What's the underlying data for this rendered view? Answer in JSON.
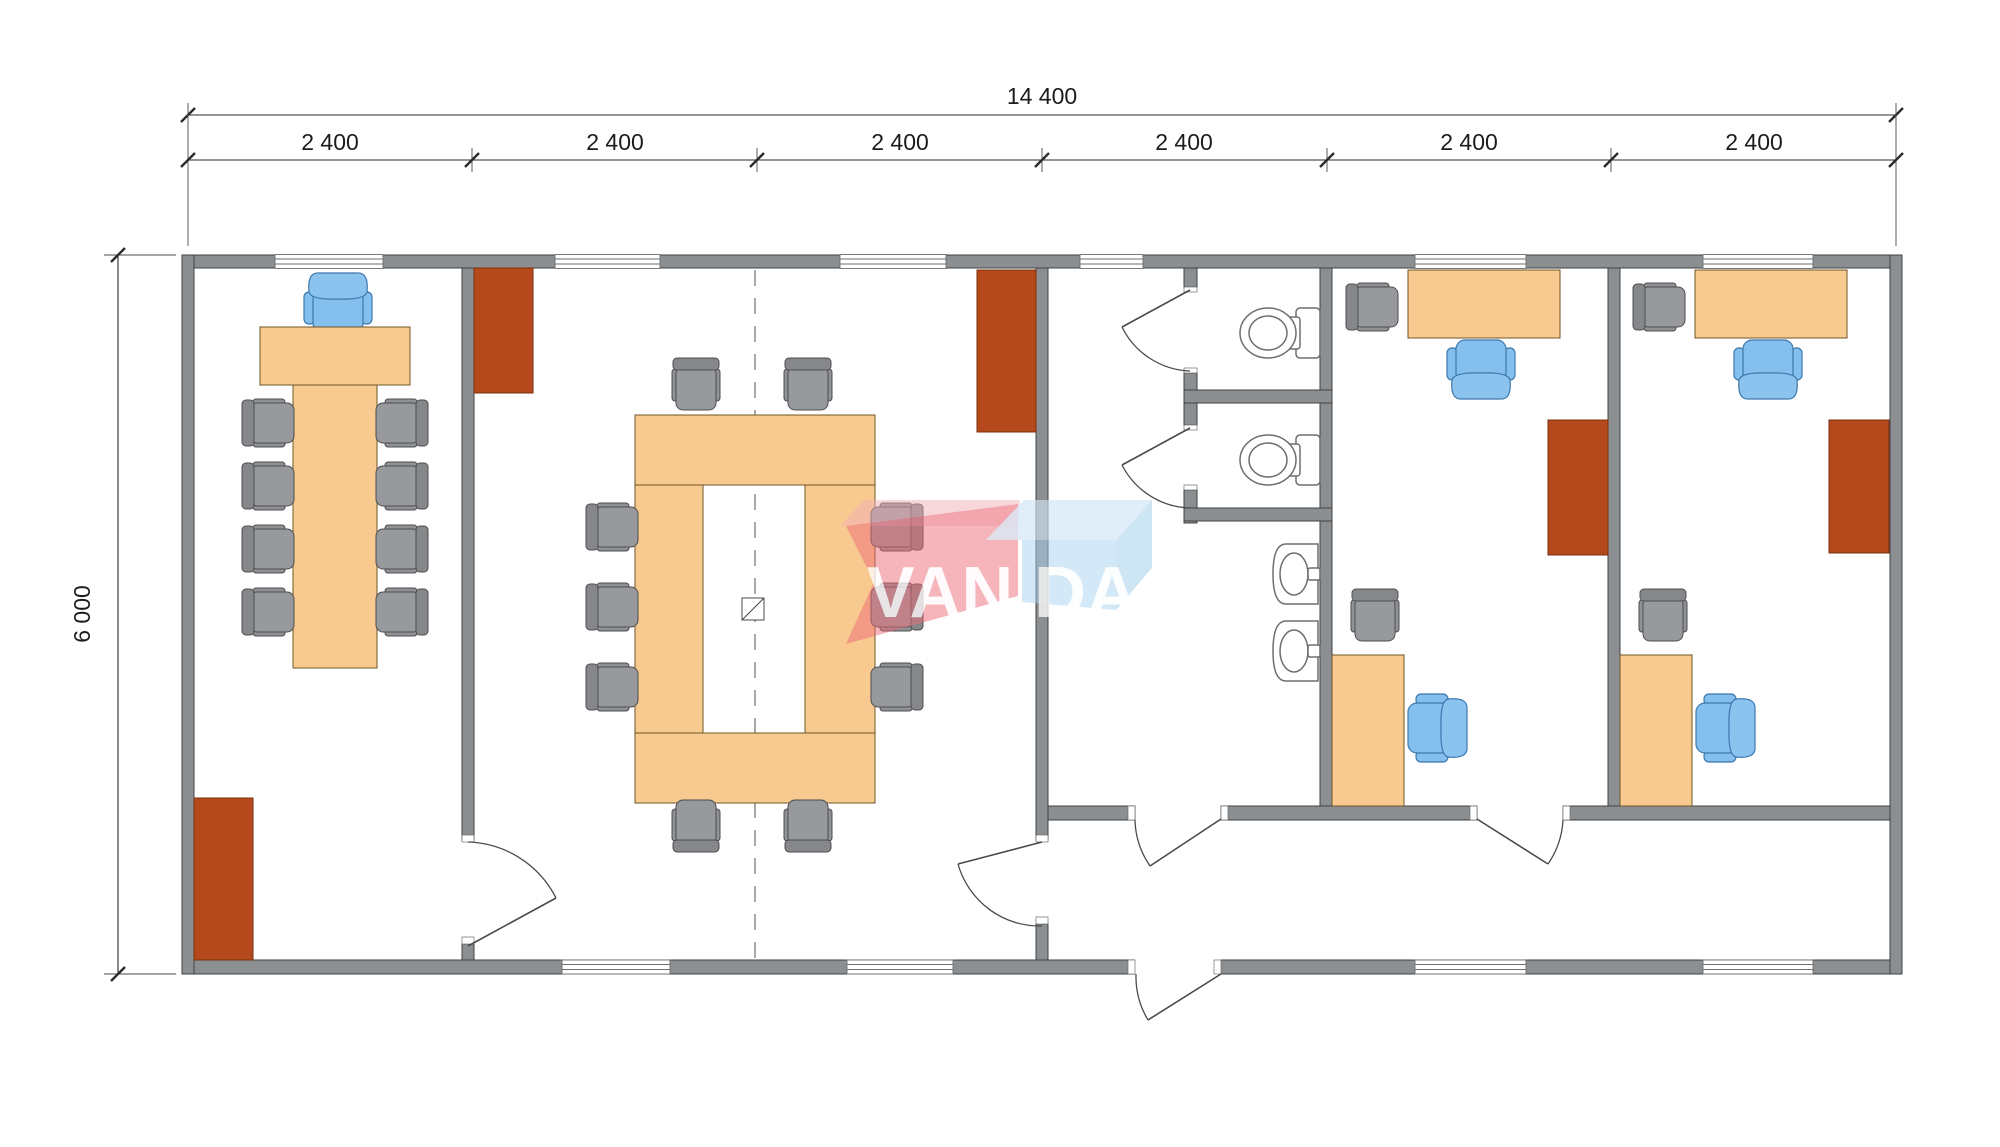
{
  "dimensions": {
    "total_width_label": "14 400",
    "segment_labels": [
      "2 400",
      "2 400",
      "2 400",
      "2 400",
      "2 400",
      "2 400"
    ],
    "height_label": "6 000"
  },
  "watermark": {
    "left_text": "VAN",
    "right_text": "DA",
    "red_color": "#ed6b77",
    "blue_color": "#a9d3ef"
  },
  "colors": {
    "wall_gray": "#8c8f91",
    "furniture_wood": "#f8ca90",
    "cabinet_rust": "#b5491c",
    "chair_blue": "#85bfed",
    "chair_gray": "#97999c",
    "sanitary_white": "#ffffff",
    "dimension_text": "#1c1c1c"
  }
}
